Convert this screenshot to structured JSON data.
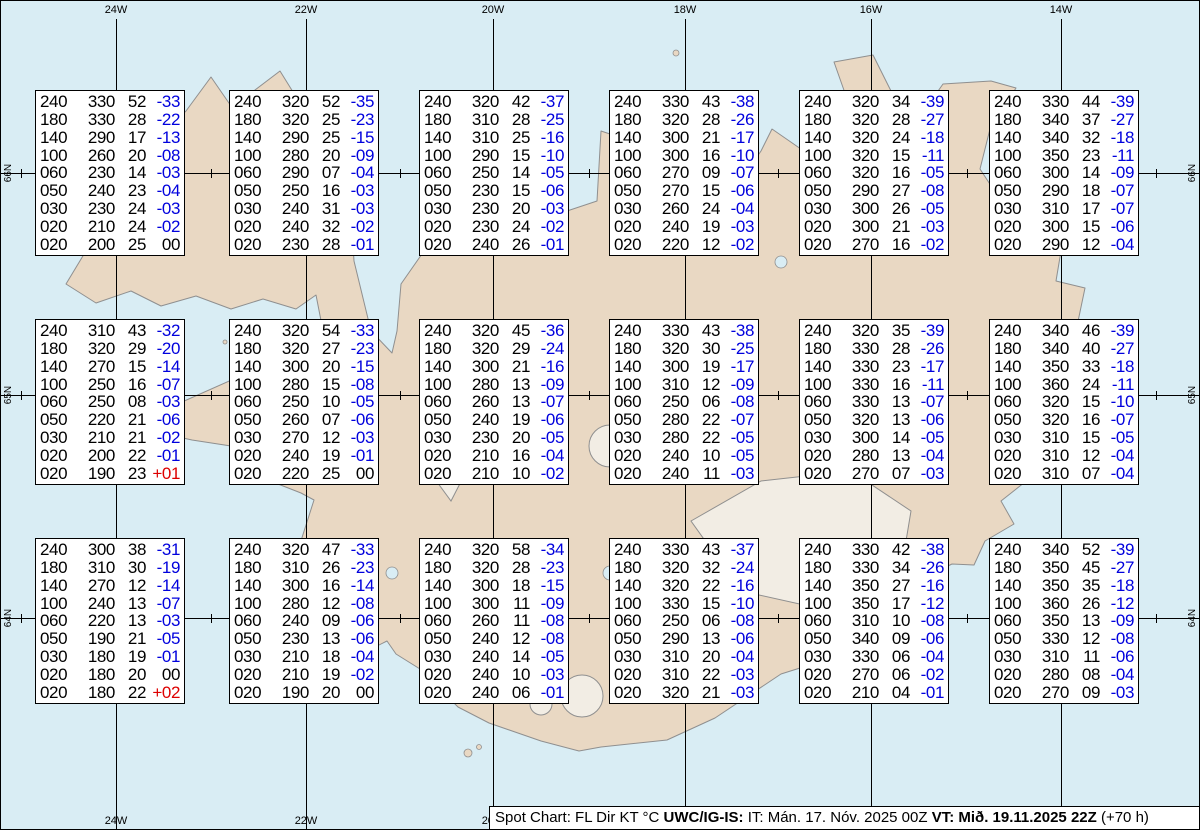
{
  "colors": {
    "ocean": "#d9edf4",
    "land": "#e9d8c3",
    "glacier": "#f2ede4",
    "coast": "#8f8f8f",
    "temp_negative": "#0000dd",
    "temp_positive": "#dd0000",
    "grid": "#000000"
  },
  "grid": {
    "meridians": [
      {
        "label": "24W",
        "x": 115
      },
      {
        "label": "22W",
        "x": 305
      },
      {
        "label": "20W",
        "x": 492
      },
      {
        "label": "18W",
        "x": 684
      },
      {
        "label": "16W",
        "x": 870
      },
      {
        "label": "14W",
        "x": 1060
      }
    ],
    "bottom_labels": [
      {
        "label": "24W",
        "x": 115
      },
      {
        "label": "22W",
        "x": 305
      },
      {
        "label": "20W",
        "x": 492
      }
    ],
    "parallels": [
      {
        "label": "66N",
        "y": 172
      },
      {
        "label": "65N",
        "y": 394
      },
      {
        "label": "64N",
        "y": 617
      }
    ],
    "tick_xs": [
      20,
      210,
      399,
      588,
      777,
      966,
      1155
    ]
  },
  "columns": [
    "FL",
    "Dir",
    "KT",
    "C"
  ],
  "stations": [
    {
      "x": 34,
      "y": 89,
      "rows": [
        [
          "240",
          "330",
          "52",
          "-33"
        ],
        [
          "180",
          "330",
          "28",
          "-22"
        ],
        [
          "140",
          "290",
          "17",
          "-13"
        ],
        [
          "100",
          "260",
          "20",
          "-08"
        ],
        [
          "060",
          "230",
          "14",
          "-03"
        ],
        [
          "050",
          "240",
          "23",
          "-04"
        ],
        [
          "030",
          "230",
          "24",
          "-03"
        ],
        [
          "020",
          "210",
          "24",
          "-02"
        ],
        [
          "020",
          "200",
          "25",
          "00"
        ]
      ]
    },
    {
      "x": 228,
      "y": 89,
      "rows": [
        [
          "240",
          "320",
          "52",
          "-35"
        ],
        [
          "180",
          "320",
          "25",
          "-23"
        ],
        [
          "140",
          "290",
          "25",
          "-15"
        ],
        [
          "100",
          "280",
          "20",
          "-09"
        ],
        [
          "060",
          "290",
          "07",
          "-04"
        ],
        [
          "050",
          "250",
          "16",
          "-03"
        ],
        [
          "030",
          "240",
          "31",
          "-03"
        ],
        [
          "020",
          "240",
          "32",
          "-02"
        ],
        [
          "020",
          "230",
          "28",
          "-01"
        ]
      ]
    },
    {
      "x": 418,
      "y": 89,
      "rows": [
        [
          "240",
          "320",
          "42",
          "-37"
        ],
        [
          "180",
          "310",
          "28",
          "-25"
        ],
        [
          "140",
          "310",
          "25",
          "-16"
        ],
        [
          "100",
          "290",
          "15",
          "-10"
        ],
        [
          "060",
          "250",
          "14",
          "-05"
        ],
        [
          "050",
          "230",
          "15",
          "-06"
        ],
        [
          "030",
          "230",
          "20",
          "-03"
        ],
        [
          "020",
          "230",
          "24",
          "-02"
        ],
        [
          "020",
          "240",
          "26",
          "-01"
        ]
      ]
    },
    {
      "x": 608,
      "y": 89,
      "rows": [
        [
          "240",
          "330",
          "43",
          "-38"
        ],
        [
          "180",
          "320",
          "28",
          "-26"
        ],
        [
          "140",
          "300",
          "21",
          "-17"
        ],
        [
          "100",
          "300",
          "16",
          "-10"
        ],
        [
          "060",
          "270",
          "09",
          "-07"
        ],
        [
          "050",
          "270",
          "15",
          "-06"
        ],
        [
          "030",
          "260",
          "24",
          "-04"
        ],
        [
          "020",
          "240",
          "19",
          "-03"
        ],
        [
          "020",
          "220",
          "12",
          "-02"
        ]
      ]
    },
    {
      "x": 798,
      "y": 89,
      "rows": [
        [
          "240",
          "320",
          "34",
          "-39"
        ],
        [
          "180",
          "320",
          "28",
          "-27"
        ],
        [
          "140",
          "320",
          "24",
          "-18"
        ],
        [
          "100",
          "320",
          "15",
          "-11"
        ],
        [
          "060",
          "320",
          "16",
          "-05"
        ],
        [
          "050",
          "290",
          "27",
          "-08"
        ],
        [
          "030",
          "300",
          "26",
          "-05"
        ],
        [
          "020",
          "300",
          "21",
          "-03"
        ],
        [
          "020",
          "270",
          "16",
          "-02"
        ]
      ]
    },
    {
      "x": 988,
      "y": 89,
      "rows": [
        [
          "240",
          "330",
          "44",
          "-39"
        ],
        [
          "180",
          "340",
          "37",
          "-27"
        ],
        [
          "140",
          "340",
          "32",
          "-18"
        ],
        [
          "100",
          "350",
          "23",
          "-11"
        ],
        [
          "060",
          "300",
          "14",
          "-09"
        ],
        [
          "050",
          "290",
          "18",
          "-07"
        ],
        [
          "030",
          "310",
          "17",
          "-07"
        ],
        [
          "020",
          "300",
          "15",
          "-06"
        ],
        [
          "020",
          "290",
          "12",
          "-04"
        ]
      ]
    },
    {
      "x": 34,
      "y": 318,
      "rows": [
        [
          "240",
          "310",
          "43",
          "-32"
        ],
        [
          "180",
          "320",
          "29",
          "-20"
        ],
        [
          "140",
          "270",
          "15",
          "-14"
        ],
        [
          "100",
          "250",
          "16",
          "-07"
        ],
        [
          "060",
          "250",
          "08",
          "-03"
        ],
        [
          "050",
          "220",
          "21",
          "-06"
        ],
        [
          "030",
          "210",
          "21",
          "-02"
        ],
        [
          "020",
          "200",
          "22",
          "-01"
        ],
        [
          "020",
          "190",
          "23",
          "+01"
        ]
      ]
    },
    {
      "x": 228,
      "y": 318,
      "rows": [
        [
          "240",
          "320",
          "54",
          "-33"
        ],
        [
          "180",
          "320",
          "27",
          "-23"
        ],
        [
          "140",
          "300",
          "20",
          "-15"
        ],
        [
          "100",
          "280",
          "15",
          "-08"
        ],
        [
          "060",
          "250",
          "10",
          "-05"
        ],
        [
          "050",
          "260",
          "07",
          "-06"
        ],
        [
          "030",
          "270",
          "12",
          "-03"
        ],
        [
          "020",
          "240",
          "19",
          "-01"
        ],
        [
          "020",
          "220",
          "25",
          "00"
        ]
      ]
    },
    {
      "x": 418,
      "y": 318,
      "rows": [
        [
          "240",
          "320",
          "45",
          "-36"
        ],
        [
          "180",
          "320",
          "29",
          "-24"
        ],
        [
          "140",
          "300",
          "21",
          "-16"
        ],
        [
          "100",
          "280",
          "13",
          "-09"
        ],
        [
          "060",
          "260",
          "13",
          "-07"
        ],
        [
          "050",
          "240",
          "19",
          "-06"
        ],
        [
          "030",
          "230",
          "20",
          "-05"
        ],
        [
          "020",
          "210",
          "16",
          "-04"
        ],
        [
          "020",
          "210",
          "10",
          "-02"
        ]
      ]
    },
    {
      "x": 608,
      "y": 318,
      "rows": [
        [
          "240",
          "330",
          "43",
          "-38"
        ],
        [
          "180",
          "320",
          "30",
          "-25"
        ],
        [
          "140",
          "300",
          "19",
          "-17"
        ],
        [
          "100",
          "310",
          "12",
          "-09"
        ],
        [
          "060",
          "250",
          "06",
          "-08"
        ],
        [
          "050",
          "280",
          "22",
          "-07"
        ],
        [
          "030",
          "280",
          "22",
          "-05"
        ],
        [
          "020",
          "240",
          "10",
          "-05"
        ],
        [
          "020",
          "240",
          "11",
          "-03"
        ]
      ]
    },
    {
      "x": 798,
      "y": 318,
      "rows": [
        [
          "240",
          "320",
          "35",
          "-39"
        ],
        [
          "180",
          "330",
          "28",
          "-26"
        ],
        [
          "140",
          "330",
          "23",
          "-17"
        ],
        [
          "100",
          "330",
          "16",
          "-11"
        ],
        [
          "060",
          "330",
          "13",
          "-07"
        ],
        [
          "050",
          "320",
          "13",
          "-06"
        ],
        [
          "030",
          "300",
          "14",
          "-05"
        ],
        [
          "020",
          "280",
          "13",
          "-04"
        ],
        [
          "020",
          "270",
          "07",
          "-03"
        ]
      ]
    },
    {
      "x": 988,
      "y": 318,
      "rows": [
        [
          "240",
          "340",
          "46",
          "-39"
        ],
        [
          "180",
          "340",
          "40",
          "-27"
        ],
        [
          "140",
          "350",
          "33",
          "-18"
        ],
        [
          "100",
          "360",
          "24",
          "-11"
        ],
        [
          "060",
          "320",
          "15",
          "-10"
        ],
        [
          "050",
          "320",
          "16",
          "-07"
        ],
        [
          "030",
          "310",
          "15",
          "-05"
        ],
        [
          "020",
          "310",
          "12",
          "-04"
        ],
        [
          "020",
          "310",
          "07",
          "-04"
        ]
      ]
    },
    {
      "x": 34,
      "y": 537,
      "rows": [
        [
          "240",
          "300",
          "38",
          "-31"
        ],
        [
          "180",
          "310",
          "30",
          "-19"
        ],
        [
          "140",
          "270",
          "12",
          "-14"
        ],
        [
          "100",
          "240",
          "13",
          "-07"
        ],
        [
          "060",
          "220",
          "13",
          "-03"
        ],
        [
          "050",
          "190",
          "21",
          "-05"
        ],
        [
          "030",
          "180",
          "19",
          "-01"
        ],
        [
          "020",
          "180",
          "20",
          "00"
        ],
        [
          "020",
          "180",
          "22",
          "+02"
        ]
      ]
    },
    {
      "x": 228,
      "y": 537,
      "rows": [
        [
          "240",
          "320",
          "47",
          "-33"
        ],
        [
          "180",
          "310",
          "26",
          "-23"
        ],
        [
          "140",
          "300",
          "16",
          "-14"
        ],
        [
          "100",
          "280",
          "12",
          "-08"
        ],
        [
          "060",
          "240",
          "09",
          "-06"
        ],
        [
          "050",
          "230",
          "13",
          "-06"
        ],
        [
          "030",
          "210",
          "18",
          "-04"
        ],
        [
          "020",
          "210",
          "19",
          "-02"
        ],
        [
          "020",
          "190",
          "20",
          "00"
        ]
      ]
    },
    {
      "x": 418,
      "y": 537,
      "rows": [
        [
          "240",
          "320",
          "58",
          "-34"
        ],
        [
          "180",
          "320",
          "28",
          "-23"
        ],
        [
          "140",
          "300",
          "18",
          "-15"
        ],
        [
          "100",
          "300",
          "11",
          "-09"
        ],
        [
          "060",
          "260",
          "11",
          "-08"
        ],
        [
          "050",
          "240",
          "12",
          "-08"
        ],
        [
          "030",
          "240",
          "14",
          "-05"
        ],
        [
          "020",
          "240",
          "10",
          "-03"
        ],
        [
          "020",
          "240",
          "06",
          "-01"
        ]
      ]
    },
    {
      "x": 608,
      "y": 537,
      "rows": [
        [
          "240",
          "330",
          "43",
          "-37"
        ],
        [
          "180",
          "320",
          "32",
          "-24"
        ],
        [
          "140",
          "320",
          "22",
          "-16"
        ],
        [
          "100",
          "330",
          "15",
          "-10"
        ],
        [
          "060",
          "250",
          "06",
          "-08"
        ],
        [
          "050",
          "290",
          "13",
          "-06"
        ],
        [
          "030",
          "310",
          "20",
          "-04"
        ],
        [
          "020",
          "310",
          "22",
          "-03"
        ],
        [
          "020",
          "320",
          "21",
          "-03"
        ]
      ]
    },
    {
      "x": 798,
      "y": 537,
      "rows": [
        [
          "240",
          "330",
          "42",
          "-38"
        ],
        [
          "180",
          "330",
          "34",
          "-26"
        ],
        [
          "140",
          "350",
          "27",
          "-16"
        ],
        [
          "100",
          "350",
          "17",
          "-12"
        ],
        [
          "060",
          "310",
          "10",
          "-08"
        ],
        [
          "050",
          "340",
          "09",
          "-06"
        ],
        [
          "030",
          "330",
          "06",
          "-04"
        ],
        [
          "020",
          "270",
          "06",
          "-02"
        ],
        [
          "020",
          "210",
          "04",
          "-01"
        ]
      ]
    },
    {
      "x": 988,
      "y": 537,
      "rows": [
        [
          "240",
          "340",
          "52",
          "-39"
        ],
        [
          "180",
          "350",
          "45",
          "-27"
        ],
        [
          "140",
          "350",
          "35",
          "-18"
        ],
        [
          "100",
          "360",
          "26",
          "-12"
        ],
        [
          "060",
          "350",
          "13",
          "-09"
        ],
        [
          "050",
          "330",
          "12",
          "-08"
        ],
        [
          "030",
          "310",
          "11",
          "-06"
        ],
        [
          "020",
          "280",
          "08",
          "-04"
        ],
        [
          "020",
          "270",
          "09",
          "-03"
        ]
      ]
    }
  ],
  "legend": {
    "segments": [
      {
        "text": "Spot Chart: FL Dir KT °C ",
        "bold": false
      },
      {
        "text": "UWC/IG-IS:",
        "bold": true
      },
      {
        "text": " IT: Mán. 17. Nóv. 2025 00Z ",
        "bold": false
      },
      {
        "text": "VT: Mið. 19.11.2025 22Z",
        "bold": true
      },
      {
        "text": " (+70 h)",
        "bold": false
      }
    ]
  }
}
